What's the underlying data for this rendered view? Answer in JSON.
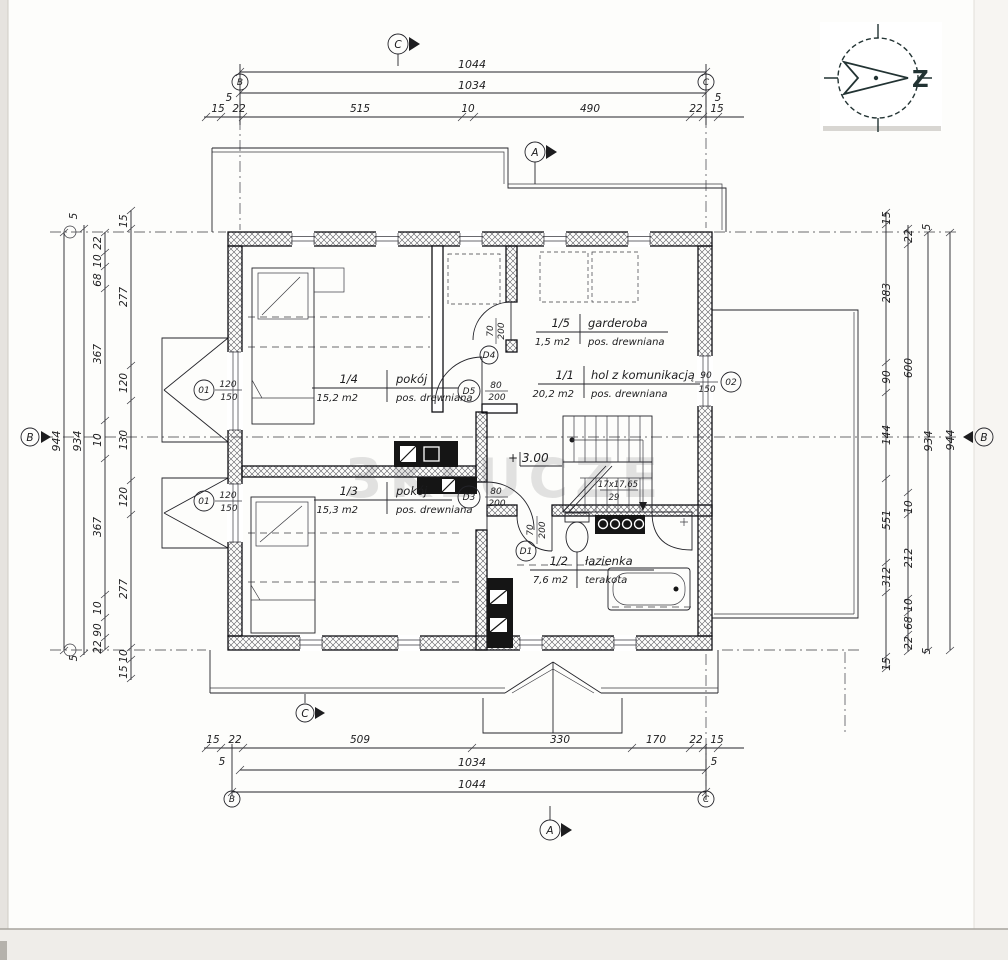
{
  "watermark": "3KLUCZE",
  "compass": {
    "north_letter": "Z"
  },
  "axes": {
    "grid_top_left": "B",
    "grid_top_right": "C",
    "grid_bottom_left": "B",
    "grid_bottom_right": "C",
    "section_top": "C",
    "section_top_a": "A",
    "section_bottom": "C",
    "section_bottom_a": "A",
    "side_left": "B",
    "side_right": "B"
  },
  "rooms": [
    {
      "id": "1/4",
      "name": "pokój",
      "area": "15,2 m2",
      "floor": "pos. drewniana"
    },
    {
      "id": "1/5",
      "name": "garderoba",
      "area": "1,5 m2",
      "floor": "pos. drewniana"
    },
    {
      "id": "1/1",
      "name": "hol z komunikacją",
      "area": "20,2 m2",
      "floor": "pos. drewniana"
    },
    {
      "id": "1/3",
      "name": "pokój",
      "area": "15,3 m2",
      "floor": "pos. drewniana"
    },
    {
      "id": "1/2",
      "name": "łazienka",
      "area": "7,6 m2",
      "floor": "terakota"
    }
  ],
  "stairs": {
    "riser": "17x17,65",
    "tread": "29",
    "level": "+ 3.00"
  },
  "doors": [
    {
      "id": "D5",
      "w": "80",
      "h": "200"
    },
    {
      "id": "D3",
      "w": "80",
      "h": "200"
    },
    {
      "id": "D4",
      "w": "70",
      "h": "200"
    },
    {
      "id": "D1",
      "w": "70",
      "h": "200"
    }
  ],
  "windows": [
    {
      "id": "01",
      "w": "120",
      "h": "150"
    },
    {
      "id": "01",
      "w": "120",
      "h": "150"
    },
    {
      "id": "02",
      "w": "90",
      "h": "150"
    }
  ],
  "dims": {
    "top": {
      "total": "1044",
      "inner": "1034",
      "tick_l": "5",
      "tick_r": "5",
      "seg": [
        "15",
        "22",
        "515",
        "10",
        "490",
        "22",
        "15"
      ]
    },
    "bottom": {
      "total": "1044",
      "inner": "1034",
      "tick_l": "5",
      "tick_r": "5",
      "seg": [
        "15",
        "22",
        "509",
        "330",
        "170",
        "22",
        "15"
      ]
    },
    "left": {
      "total": "944",
      "inner": "934",
      "tick_t": "5",
      "tick_b": "5",
      "chain_a": [
        "22",
        "10",
        "68",
        "367",
        "10",
        "367",
        "10",
        "90",
        "22"
      ],
      "chain_b": [
        "15",
        "277",
        "120",
        "130",
        "120",
        "277",
        "10",
        "15"
      ]
    },
    "right": {
      "total": "944",
      "inner": "934",
      "tick_t": "5",
      "tick_b": "5",
      "chain_a": [
        "15",
        "283",
        "90",
        "144",
        "551",
        "312",
        "15"
      ],
      "chain_b": [
        "22",
        "600",
        "10",
        "212",
        "10",
        "68",
        "22"
      ]
    }
  }
}
